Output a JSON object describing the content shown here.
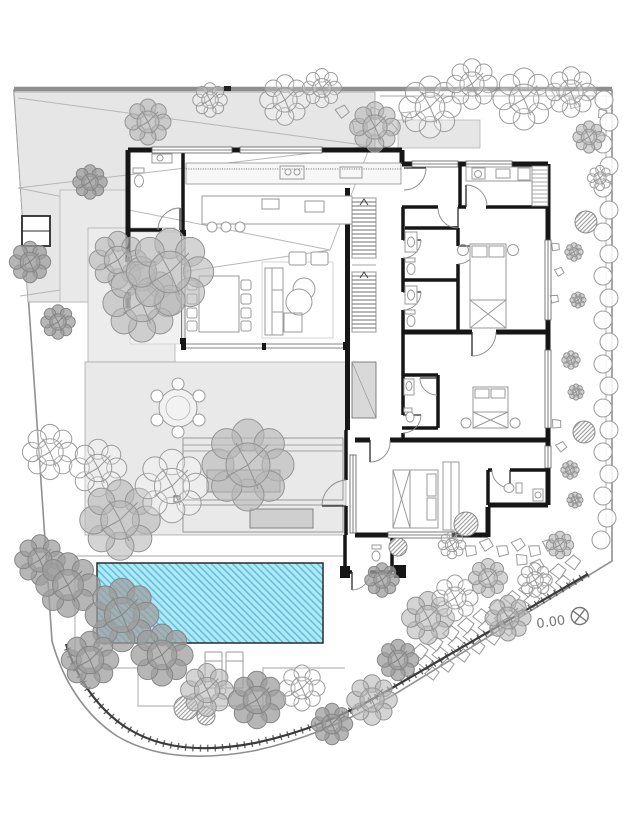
{
  "annotations": {
    "elevation_label": "0.00",
    "benchmark_icon": "level-benchmark-circle-x"
  },
  "colors": {
    "wall": "#161616",
    "pool_water": "#b6e7f4",
    "pool_hatch": "#57c6e2",
    "paving": "#e9e9e9",
    "veranda_paving": "#ececec",
    "driveway": "#e6e6e6",
    "planter": "#cfcfcf",
    "tree_line": "#9b9b9b",
    "tree_fill": "#b7b7b7",
    "boundary": "#8f8f8f",
    "retaining_wall": "#3a3a3a",
    "annotation_text": "#757575"
  }
}
